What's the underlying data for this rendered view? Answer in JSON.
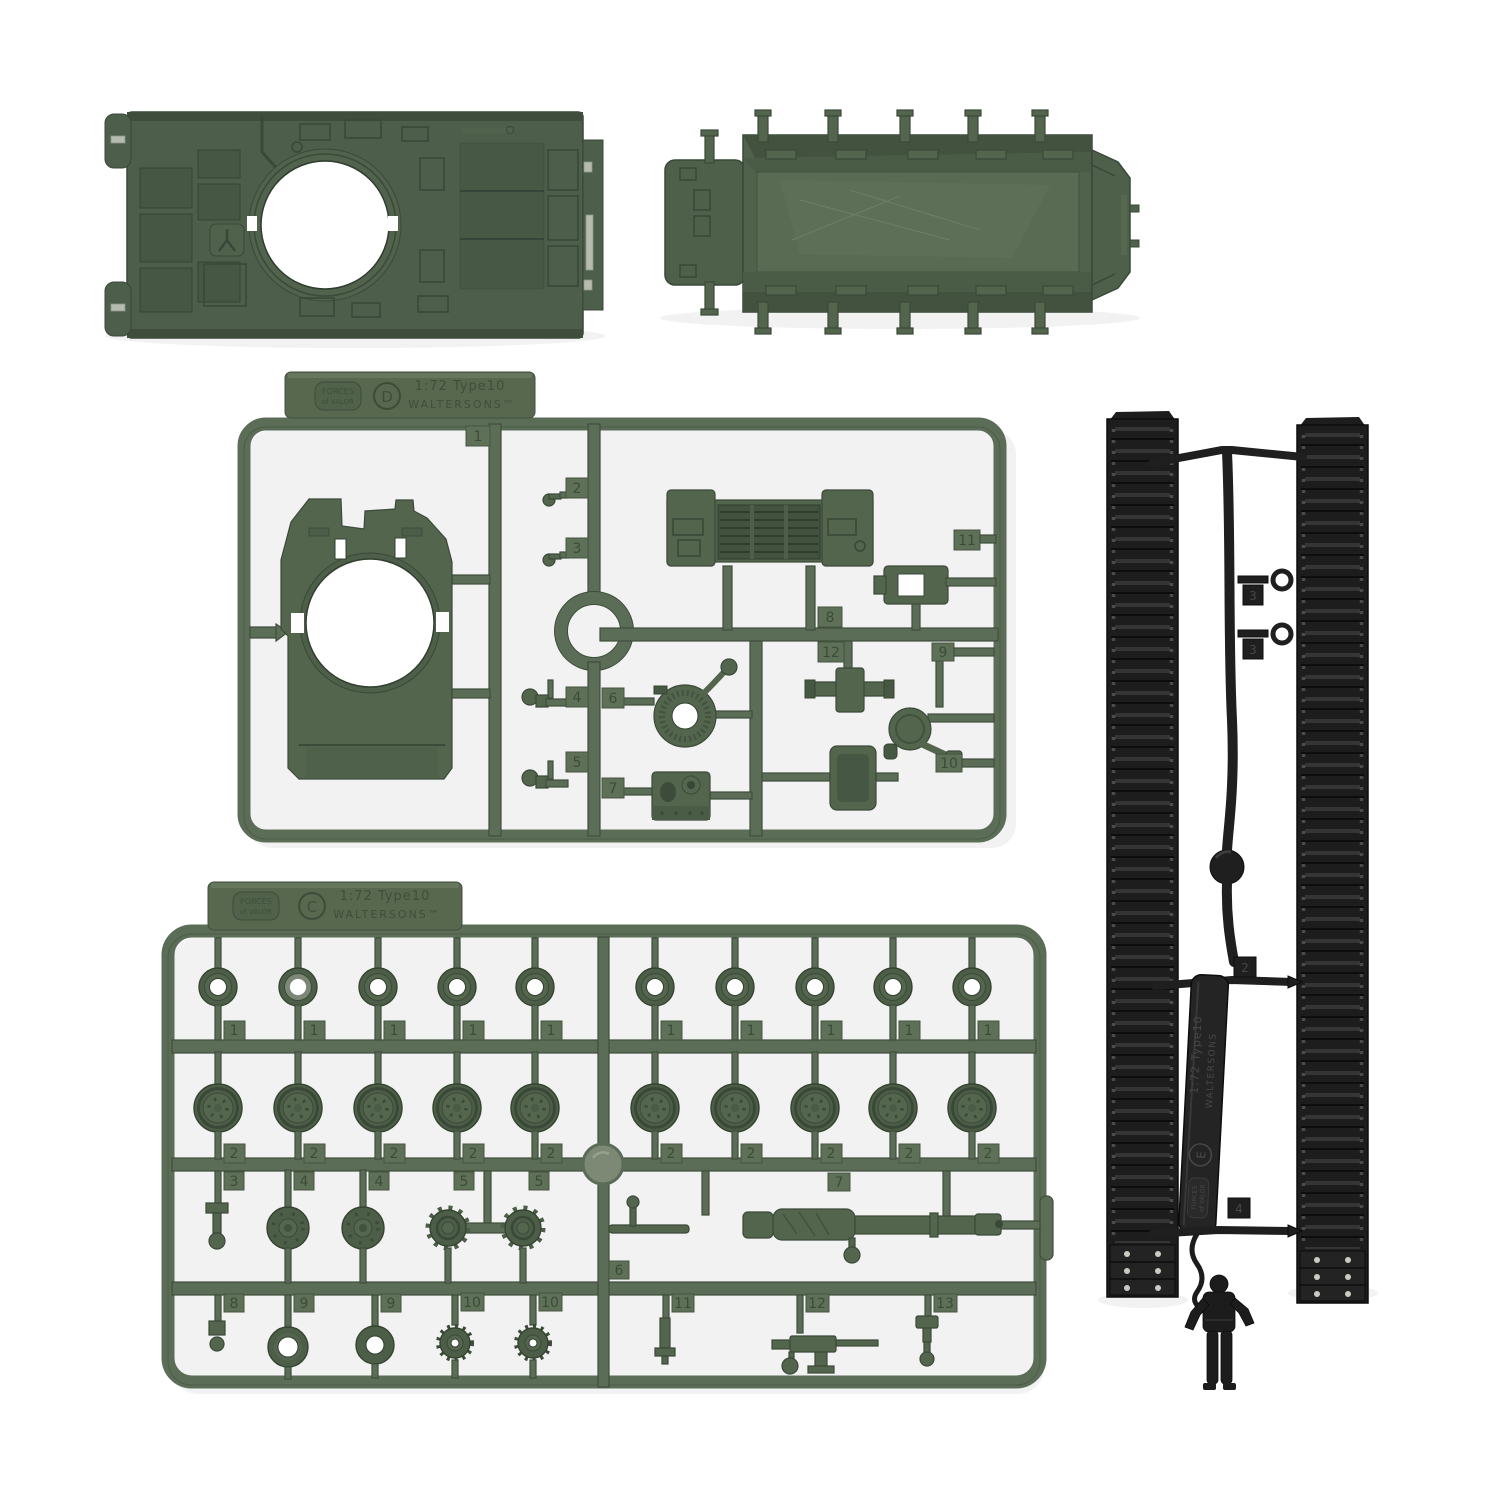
{
  "branding": {
    "logo_line1": "FORCES",
    "logo_line2": "of VALOR",
    "scale_text": "1:72 Type10",
    "maker_text": "WALTERSONS™"
  },
  "sprue_d": {
    "letter": "D",
    "tags": [
      "1",
      "2",
      "3",
      "4",
      "5",
      "6",
      "7",
      "8",
      "9",
      "10",
      "11",
      "12"
    ]
  },
  "sprue_c": {
    "letter": "C",
    "row1": [
      "1",
      "1",
      "1",
      "1",
      "1",
      "1",
      "1",
      "1",
      "1",
      "1"
    ],
    "row2": [
      "2",
      "2",
      "2",
      "2",
      "2",
      "2",
      "2",
      "2",
      "2",
      "2"
    ],
    "row3": [
      "3",
      "4",
      "4",
      "5",
      "5",
      "6",
      "7"
    ],
    "row4": [
      "8",
      "9",
      "9",
      "10",
      "10",
      "11",
      "12",
      "13"
    ]
  },
  "sprue_e": {
    "letter": "E",
    "scale_text": "1:72 Type10",
    "maker_text": "WALTERSONS",
    "tags": [
      "3",
      "3",
      "2",
      "4"
    ]
  },
  "colors": {
    "background": "#ffffff",
    "sprue_green": "#5c6d57",
    "sprue_green_dark": "#42513e",
    "part_green": "#54654e",
    "hull_green": "#4d5e4a",
    "black_plastic": "#1f1f1f",
    "track_rib": "#343434",
    "metal_gray": "#b5bbaf"
  }
}
